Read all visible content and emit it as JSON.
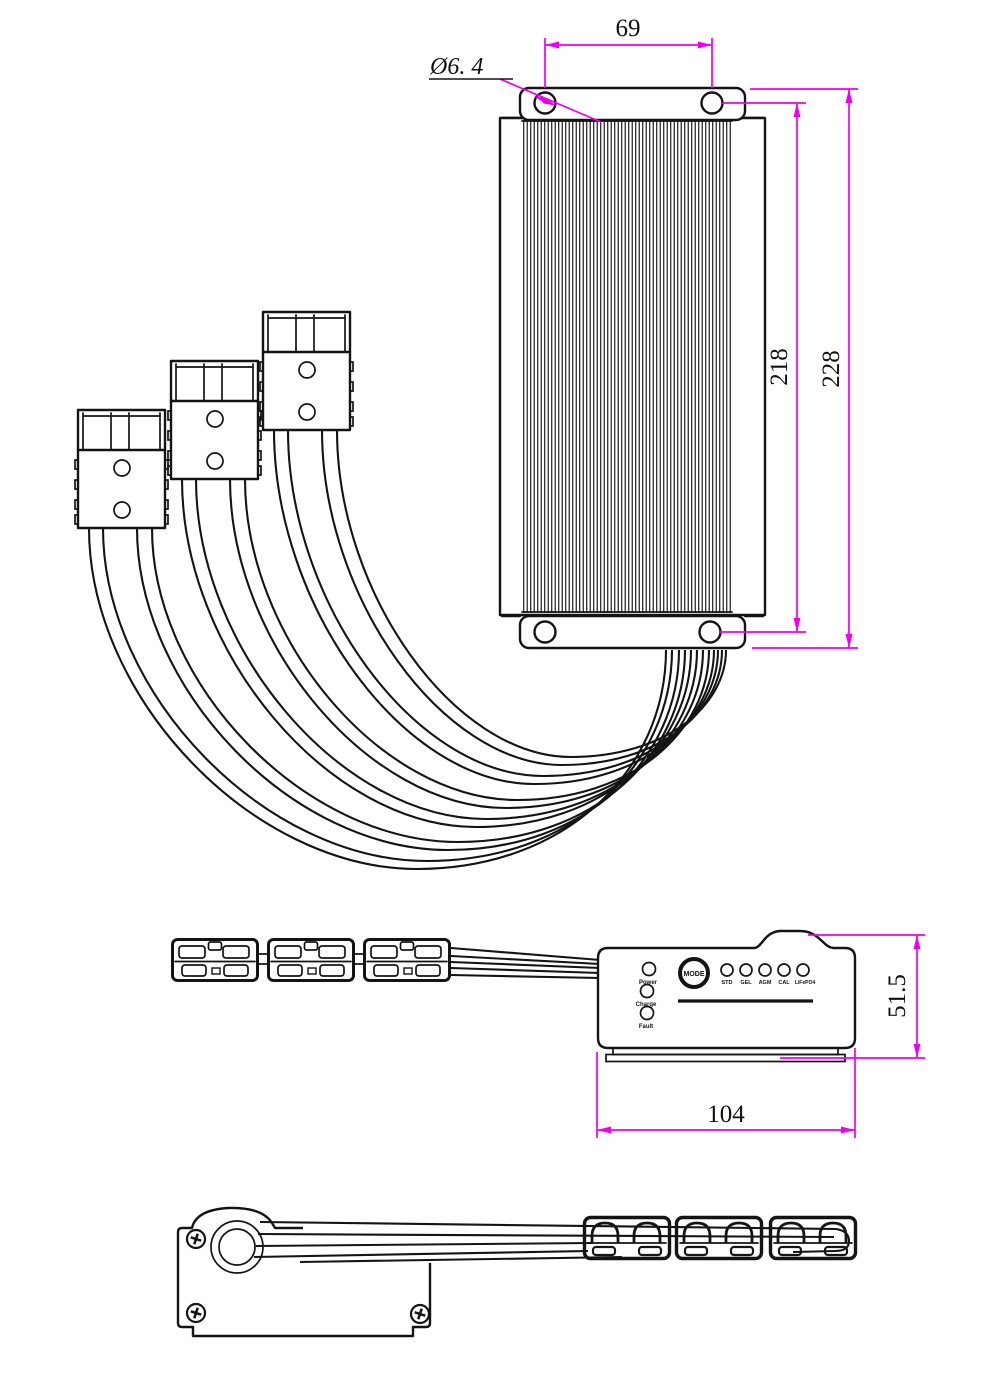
{
  "drawing": {
    "dimensions": {
      "hole_spacing": "69",
      "hole_diameter": "Ø6. 4",
      "body_height": "218",
      "overall_height": "228",
      "side_height": "51.5",
      "side_width": "104"
    },
    "panel": {
      "mode_button": "MODE",
      "status_leds": [
        {
          "label": "Power"
        },
        {
          "label": "Charge"
        },
        {
          "label": "Fault"
        }
      ],
      "mode_leds": [
        {
          "label": "STD"
        },
        {
          "label": "GEL"
        },
        {
          "label": "AGM"
        },
        {
          "label": "CAL"
        },
        {
          "label": "LiFePO4"
        }
      ]
    },
    "colors": {
      "dimension": "#ee00ee",
      "line": "#141414",
      "background": "#ffffff"
    }
  }
}
